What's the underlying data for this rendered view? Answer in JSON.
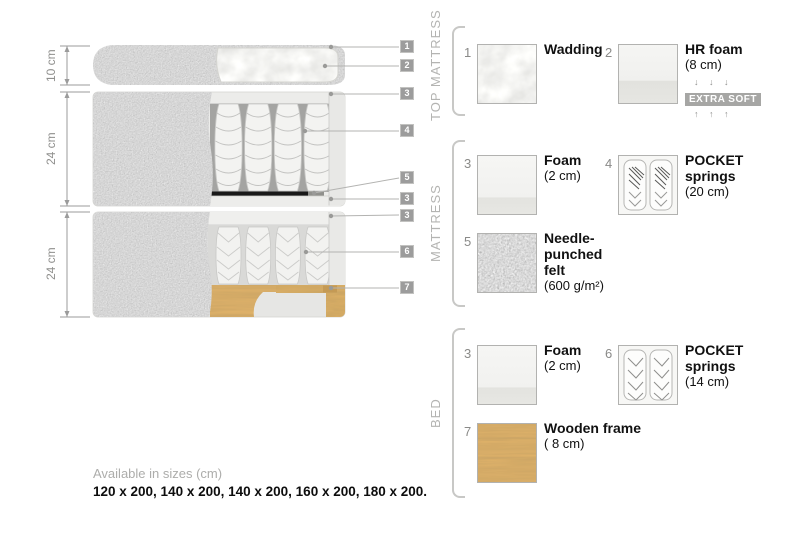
{
  "diagram": {
    "dimensions": [
      "10 cm",
      "24 cm",
      "24 cm"
    ],
    "callouts": [
      "1",
      "2",
      "3",
      "4",
      "5",
      "3",
      "3",
      "6",
      "7"
    ],
    "layers": [
      "top mattress",
      "mattress",
      "bed"
    ]
  },
  "legend": {
    "sections": [
      {
        "title": "TOP MATTRESS",
        "items": [
          {
            "num": "1",
            "name": "Wadding",
            "detail": "",
            "swatch": "wadding-texture"
          },
          {
            "num": "2",
            "name": "HR foam",
            "detail": "(8 cm)",
            "swatch": "hr-foam-swatch",
            "arrows_down": "↓ ↓ ↓",
            "badge": "EXTRA SOFT",
            "arrows_up": "↑ ↑ ↑"
          }
        ]
      },
      {
        "title": "MATTRESS",
        "items": [
          {
            "num": "3",
            "name": "Foam",
            "detail": "(2 cm)",
            "swatch": "foam-swatch"
          },
          {
            "num": "4",
            "name": "POCKET springs",
            "detail": "(20 cm)",
            "swatch": "pocket-springs-swatch"
          },
          {
            "num": "5",
            "name": "Needle-punched felt",
            "detail": "(600 g/m²)",
            "swatch": "felt-texture"
          }
        ]
      },
      {
        "title": "BED",
        "items": [
          {
            "num": "3",
            "name": "Foam",
            "detail": "(2 cm)",
            "swatch": "foam-swatch"
          },
          {
            "num": "6",
            "name": "POCKET springs",
            "detail": "(14 cm)",
            "swatch": "pocket-springs-swatch"
          },
          {
            "num": "7",
            "name": "Wooden frame",
            "detail": "( 8  cm)",
            "swatch": "wood-texture"
          }
        ]
      }
    ]
  },
  "footer": {
    "sizes_caption": "Available in sizes (cm)",
    "sizes_list": "120 x 200, 140 x 200, 140 x 200, 160 x 200, 180 x 200."
  },
  "colors": {
    "fabric_gray": "#a9a9a9",
    "felt_black": "#191919",
    "wood": "#e0b269",
    "chip_bg": "#9c9c9c",
    "badge_bg": "#a6a6a4"
  }
}
